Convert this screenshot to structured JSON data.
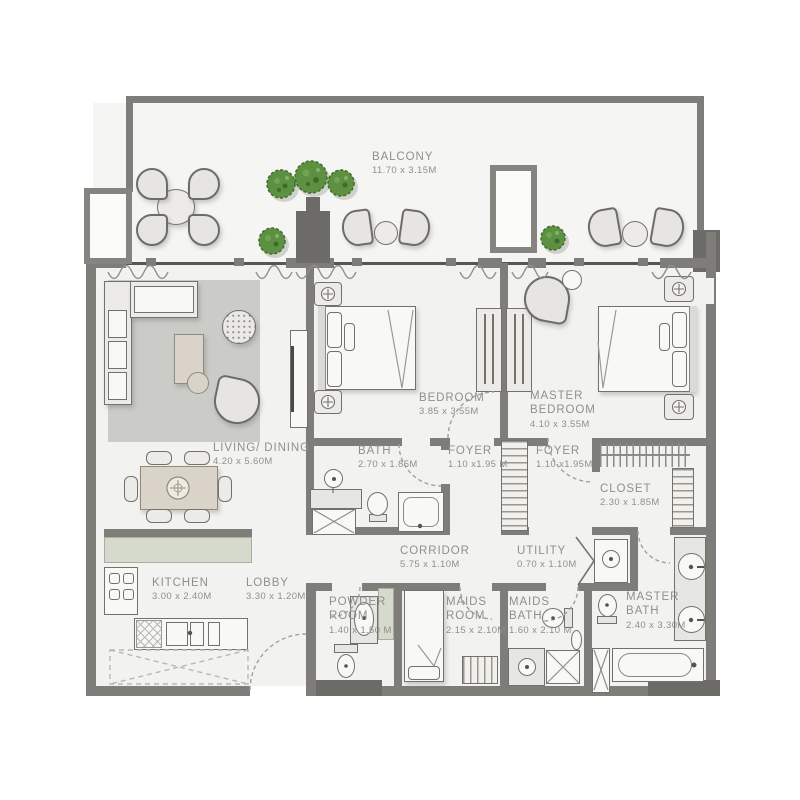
{
  "colors": {
    "wall": "#7e7d79",
    "wall_dark": "#6c6b67",
    "floor": "#f2f2f0",
    "furniture": "#ecebe7",
    "kitchen_counter": "#d6dacd",
    "rug": "#cbcbc8",
    "plant_green": "#5d9040",
    "label_text": "#8f8f8f"
  },
  "rooms": {
    "balcony": {
      "name": "BALCONY",
      "dims": "11.70 x 3.15M"
    },
    "living_dining": {
      "name": "LIVING/ DINING",
      "dims": "4.20 x 5.60M"
    },
    "bedroom": {
      "name": "BEDROOM",
      "dims": "3.85 x 3.55M"
    },
    "master_bedroom": {
      "name": "MASTER BEDROOM",
      "dims": "4.10 x 3.55M"
    },
    "bath": {
      "name": "BATH",
      "dims": "2.70 x 1.85M"
    },
    "foyer_a": {
      "name": "FOYER",
      "dims": "1.10 x1.95 M"
    },
    "foyer_b": {
      "name": "FOYER",
      "dims": "1.10 x1.95M"
    },
    "closet": {
      "name": "CLOSET",
      "dims": "2.30 x 1.85M"
    },
    "corridor": {
      "name": "CORRIDOR",
      "dims": "5.75 x 1.10M"
    },
    "utility": {
      "name": "UTILITY",
      "dims": "0.70 x 1.10M"
    },
    "kitchen": {
      "name": "KITCHEN",
      "dims": "3.00 x 2.40M"
    },
    "lobby": {
      "name": "LOBBY",
      "dims": "3.30 x 1.20M"
    },
    "powder_room": {
      "name": "POWDER ROOM",
      "dims": "1.40 x 1.50 M"
    },
    "maids_room": {
      "name": "MAIDS ROOM",
      "dims": "2.15 x 2.10M"
    },
    "maids_bath": {
      "name": "MAIDS BATH",
      "dims": "1.60 x 2.10 M"
    },
    "master_bath": {
      "name": "MASTER BATH",
      "dims": "2.40 x 3.30M"
    }
  }
}
